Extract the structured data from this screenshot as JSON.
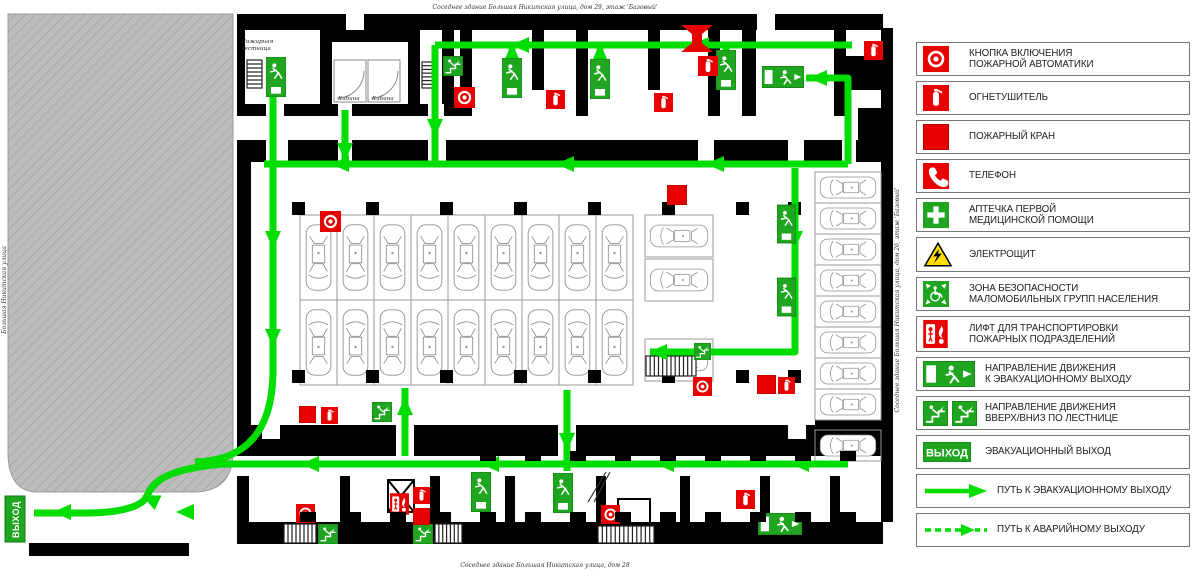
{
  "titles": {
    "top": "Соседнее здание Большая Никитская улица, дом 29, этаж 'Базовый'",
    "bottom": "Соседнее здание Большая Никитская улица, дом 28",
    "left_vertical": "Большая Никитская улица",
    "right_vertical": "Соседнее здание Большая Никитская улица, дом 26, этаж 'Базовый'"
  },
  "plan": {
    "labels": {
      "fire_stairs": "Пожарная\nлестница",
      "cabin": "Кабина",
      "exit": "ВЫХОД"
    },
    "colors": {
      "route_green": "#00dd00",
      "sign_green": "#1fa51f",
      "alarm_red": "#e80000",
      "warning_yellow": "#ffdf00",
      "building_gray": "#bcbcbc"
    },
    "routes": [
      {
        "pts": [
          [
            852,
            45
          ],
          [
            435,
            45
          ]
        ]
      },
      {
        "pts": [
          [
            435,
            45
          ],
          [
            435,
            162
          ]
        ]
      },
      {
        "pts": [
          [
            806,
            78
          ],
          [
            848,
            78
          ],
          [
            848,
            164
          ]
        ]
      },
      {
        "pts": [
          [
            264,
            164
          ],
          [
            848,
            164
          ]
        ]
      },
      {
        "d": "M273,97 L273,370 Q273,460 195,462"
      },
      {
        "pts": [
          [
            848,
            464
          ],
          [
            215,
            464
          ]
        ]
      },
      {
        "d": "M223,464 C168,469 154,480 147,496 C141,509 112,513 86,513 L34,513"
      },
      {
        "pts": [
          [
            795,
            168
          ],
          [
            795,
            352
          ],
          [
            650,
            352
          ]
        ]
      },
      {
        "pts": [
          [
            567,
            390
          ],
          [
            567,
            471
          ]
        ]
      },
      {
        "pts": [
          [
            405,
            456
          ],
          [
            405,
            388
          ]
        ]
      },
      {
        "pts": [
          [
            345,
            110
          ],
          [
            345,
            163
          ]
        ]
      },
      {
        "pts": [
          [
            512,
            74
          ],
          [
            512,
            47
          ]
        ]
      },
      {
        "pts": [
          [
            600,
            74
          ],
          [
            600,
            47
          ]
        ]
      },
      {
        "pts": [
          [
            726,
            66
          ],
          [
            726,
            47
          ]
        ]
      }
    ],
    "arrows": [
      {
        "x": 520,
        "y": 45,
        "a": 180
      },
      {
        "x": 700,
        "y": 45,
        "a": 180
      },
      {
        "x": 818,
        "y": 78,
        "a": 180
      },
      {
        "x": 512,
        "y": 52,
        "a": -90
      },
      {
        "x": 600,
        "y": 52,
        "a": -90
      },
      {
        "x": 726,
        "y": 52,
        "a": -90
      },
      {
        "x": 435,
        "y": 128,
        "a": 90
      },
      {
        "x": 345,
        "y": 152,
        "a": 90
      },
      {
        "x": 340,
        "y": 164,
        "a": 180
      },
      {
        "x": 565,
        "y": 164,
        "a": 180
      },
      {
        "x": 715,
        "y": 164,
        "a": 180
      },
      {
        "x": 273,
        "y": 240,
        "a": 90
      },
      {
        "x": 273,
        "y": 338,
        "a": 90
      },
      {
        "x": 795,
        "y": 240,
        "a": 90
      },
      {
        "x": 700,
        "y": 352,
        "a": 180
      },
      {
        "x": 658,
        "y": 352,
        "a": 180
      },
      {
        "x": 567,
        "y": 442,
        "a": 90
      },
      {
        "x": 405,
        "y": 406,
        "a": -90
      },
      {
        "x": 310,
        "y": 464,
        "a": 180
      },
      {
        "x": 490,
        "y": 464,
        "a": 180
      },
      {
        "x": 665,
        "y": 464,
        "a": 180
      },
      {
        "x": 800,
        "y": 464,
        "a": 180
      },
      {
        "x": 150,
        "y": 499,
        "a": 205
      },
      {
        "x": 62,
        "y": 512,
        "a": 180
      },
      {
        "x": 185,
        "y": 512,
        "a": 180
      }
    ],
    "icons": [
      {
        "t": "evac-v",
        "x": 266,
        "y": 57,
        "w": 20,
        "h": 40
      },
      {
        "t": "evac-v",
        "x": 502,
        "y": 58,
        "w": 20,
        "h": 40
      },
      {
        "t": "evac-v",
        "x": 590,
        "y": 59,
        "w": 20,
        "h": 40
      },
      {
        "t": "evac-v",
        "x": 716,
        "y": 50,
        "w": 20,
        "h": 40
      },
      {
        "t": "evac-v",
        "x": 777,
        "y": 204,
        "w": 19,
        "h": 40
      },
      {
        "t": "evac-v",
        "x": 777,
        "y": 277,
        "w": 19,
        "h": 40
      },
      {
        "t": "evac-v",
        "x": 471,
        "y": 472,
        "w": 20,
        "h": 40
      },
      {
        "t": "evac-v",
        "x": 553,
        "y": 473,
        "w": 20,
        "h": 40
      },
      {
        "t": "evac-h",
        "x": 762,
        "y": 66,
        "w": 42,
        "h": 22
      },
      {
        "t": "evac-h",
        "x": 758,
        "y": 513,
        "w": 44,
        "h": 22
      },
      {
        "t": "stair-sign",
        "x": 443,
        "y": 56,
        "w": 20,
        "h": 20
      },
      {
        "t": "stair-sign",
        "x": 372,
        "y": 402,
        "w": 20,
        "h": 20
      },
      {
        "t": "stair-sign",
        "x": 318,
        "y": 524,
        "w": 20,
        "h": 20
      },
      {
        "t": "stair-sign",
        "x": 413,
        "y": 524,
        "w": 20,
        "h": 20
      },
      {
        "t": "stair-sign",
        "x": 694,
        "y": 343,
        "w": 17,
        "h": 17
      },
      {
        "t": "fire-button",
        "x": 320,
        "y": 211,
        "w": 21,
        "h": 21
      },
      {
        "t": "fire-button",
        "x": 454,
        "y": 87,
        "w": 21,
        "h": 21
      },
      {
        "t": "fire-button",
        "x": 693,
        "y": 377,
        "w": 19,
        "h": 19
      },
      {
        "t": "fire-button",
        "x": 296,
        "y": 504,
        "w": 19,
        "h": 19
      },
      {
        "t": "fire-button",
        "x": 601,
        "y": 505,
        "w": 19,
        "h": 19
      },
      {
        "t": "extinguisher",
        "x": 546,
        "y": 90,
        "w": 19,
        "h": 19
      },
      {
        "t": "extinguisher",
        "x": 654,
        "y": 93,
        "w": 19,
        "h": 19
      },
      {
        "t": "extinguisher",
        "x": 698,
        "y": 56,
        "w": 20,
        "h": 20
      },
      {
        "t": "extinguisher",
        "x": 864,
        "y": 41,
        "w": 19,
        "h": 19
      },
      {
        "t": "extinguisher",
        "x": 321,
        "y": 407,
        "w": 17,
        "h": 17
      },
      {
        "t": "extinguisher",
        "x": 413,
        "y": 487,
        "w": 17,
        "h": 17
      },
      {
        "t": "extinguisher",
        "x": 736,
        "y": 490,
        "w": 19,
        "h": 19
      },
      {
        "t": "extinguisher",
        "x": 778,
        "y": 377,
        "w": 17,
        "h": 17
      },
      {
        "t": "hydrant",
        "x": 667,
        "y": 185,
        "w": 20,
        "h": 20
      },
      {
        "t": "hydrant",
        "x": 299,
        "y": 406,
        "w": 17,
        "h": 17
      },
      {
        "t": "hydrant",
        "x": 413,
        "y": 508,
        "w": 17,
        "h": 17
      },
      {
        "t": "hydrant",
        "x": 757,
        "y": 375,
        "w": 19,
        "h": 19
      },
      {
        "t": "dry-riser",
        "x": 681,
        "y": 25,
        "w": 32,
        "h": 27
      },
      {
        "t": "fire-lift",
        "x": 390,
        "y": 493,
        "w": 19,
        "h": 22
      }
    ],
    "ladders": [
      {
        "x": 247,
        "y": 60,
        "w": 15,
        "h": 28,
        "n": 7,
        "o": "h"
      },
      {
        "x": 422,
        "y": 62,
        "w": 14,
        "h": 26,
        "n": 7,
        "o": "h"
      },
      {
        "x": 284,
        "y": 524,
        "w": 32,
        "h": 19,
        "n": 8,
        "o": "v"
      },
      {
        "x": 435,
        "y": 524,
        "w": 27,
        "h": 19,
        "n": 7,
        "o": "v"
      },
      {
        "x": 598,
        "y": 526,
        "w": 56,
        "h": 17,
        "n": 13,
        "o": "v"
      },
      {
        "x": 646,
        "y": 356,
        "w": 50,
        "h": 20,
        "n": 12,
        "o": "v"
      }
    ],
    "parking": {
      "center": {
        "x0": 300,
        "cols": 9,
        "w": 37,
        "topY": 215,
        "botY": 300,
        "h": 85
      },
      "right_sub": {
        "w": 68,
        "h": 42,
        "stalls": [
          [
            645,
            215
          ],
          [
            645,
            259
          ],
          [
            645,
            339
          ]
        ]
      },
      "right_col": {
        "x": 815,
        "y0": 172,
        "count": 8,
        "w": 66,
        "h": 31,
        "extraY": 430
      }
    }
  },
  "legend": {
    "items": [
      {
        "icon": "fire-button",
        "label": "КНОПКА ВКЛЮЧЕНИЯ\nПОЖАРНОЙ АВТОМАТИКИ"
      },
      {
        "icon": "extinguisher",
        "label": "ОГНЕТУШИТЕЛЬ"
      },
      {
        "icon": "hydrant",
        "label": "ПОЖАРНЫЙ КРАН"
      },
      {
        "icon": "phone",
        "label": "ТЕЛЕФОН"
      },
      {
        "icon": "first-aid",
        "label": "АПТЕЧКА ПЕРВОЙ\nМЕДИЦИНСКОЙ ПОМОЩИ"
      },
      {
        "icon": "electro",
        "label": "ЭЛЕКТРОЩИТ"
      },
      {
        "icon": "safety-zone",
        "label": "ЗОНА БЕЗОПАСНОСТИ\nМАЛОМОБИЛЬНЫХ ГРУПП НАСЕЛЕНИЯ"
      },
      {
        "icon": "fire-lift",
        "label": "ЛИФТ ДЛЯ ТРАНСПОРТИРОВКИ\nПОЖАРНЫХ ПОДРАЗДЕЛЕНИЙ"
      },
      {
        "icon": "evac-h",
        "label": "НАПРАВЛЕНИЕ ДВИЖЕНИЯ\nК ЭВАКУАЦИОННОМУ ВЫХОДУ"
      },
      {
        "icon": "stairs-two",
        "label": "НАПРАВЛЕНИЕ ДВИЖЕНИЯ\nВВЕРХ/ВНИЗ ПО ЛЕСТНИЦЕ"
      },
      {
        "icon": "exit",
        "label": "ЭВАКУАЦИОННЫЙ ВЫХОД"
      },
      {
        "icon": "arrow-solid",
        "label": "ПУТЬ К ЭВАКУАЦИОННОМУ ВЫХОДУ"
      },
      {
        "icon": "arrow-dashed",
        "label": "ПУТЬ К АВАРИЙНОМУ  ВЫХОДУ"
      }
    ]
  }
}
